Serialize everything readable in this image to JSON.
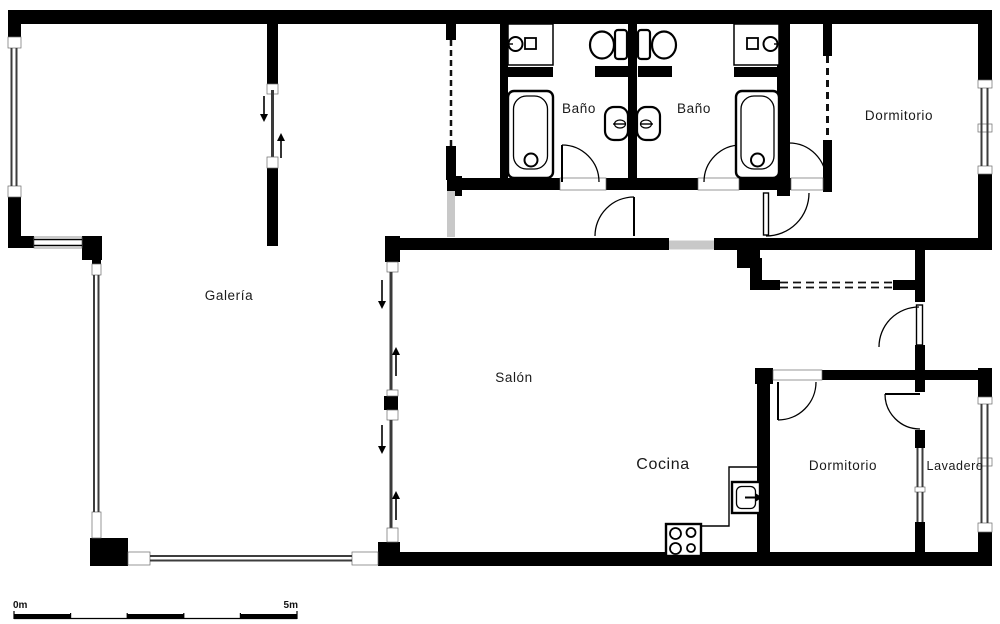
{
  "rooms": {
    "bathroom_left": {
      "label": "Baño"
    },
    "bathroom_right": {
      "label": "Baño"
    },
    "bedroom_top": {
      "label": "Dormitorio"
    },
    "gallery": {
      "label": "Galería"
    },
    "living_room": {
      "label": "Salón"
    },
    "kitchen": {
      "label": "Cocina"
    },
    "bedroom_bottom": {
      "label": "Dormitorio"
    },
    "laundry": {
      "label": "Lavadero"
    }
  },
  "scale_bar": {
    "start_label": "0m",
    "end_label": "5m",
    "segments": 5,
    "meters_per_segment": 1
  },
  "colors": {
    "wall": "#000000",
    "background": "#ffffff",
    "opening": "#c8c8c8",
    "glass": "#3d3d3d"
  },
  "fixtures": [
    "bathtub",
    "toilet",
    "bidet",
    "washbasin",
    "kitchen-sink",
    "stove",
    "counter",
    "sliding-door-arrow",
    "closet-dashed-doors",
    "door-swing"
  ]
}
